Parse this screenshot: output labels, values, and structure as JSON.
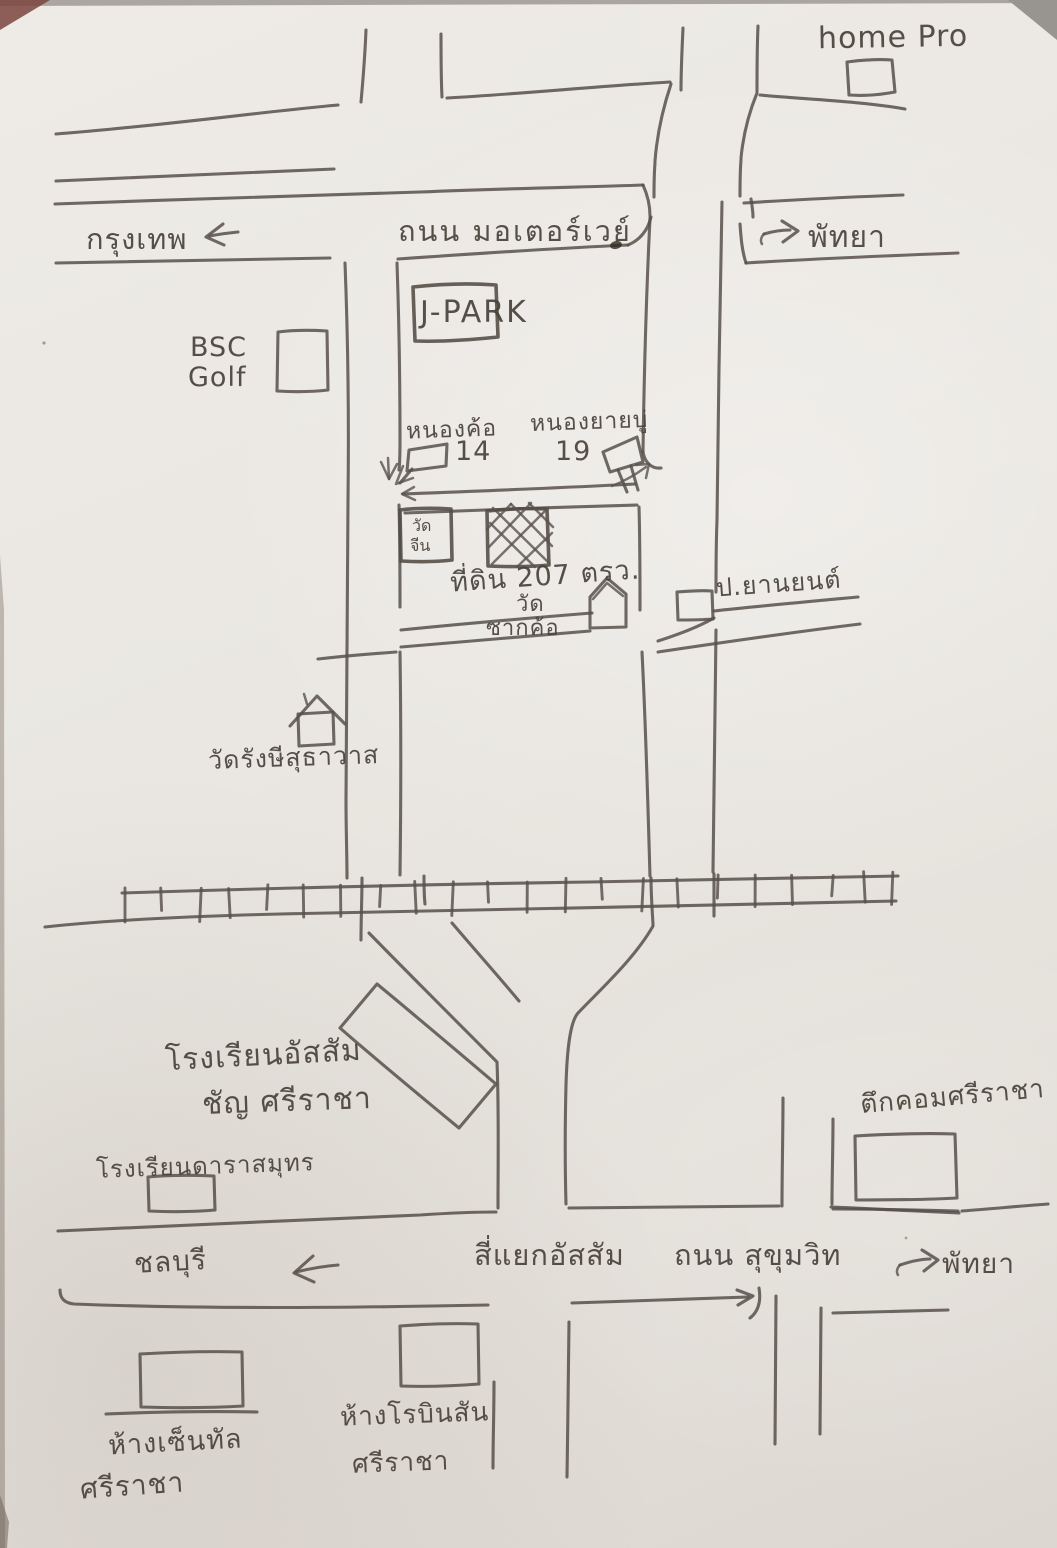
{
  "map": {
    "kind": "hand-drawn-sketch-map",
    "ink_color": "#57504a",
    "paper_color": "#eae7e2",
    "labels": {
      "home_pro": "home Pro",
      "bangkok": "กรุงเทพ",
      "motorway_road": "ถนน มอเตอร์เวย์",
      "pattaya_top": "พัทยา",
      "j_park": "J-PARK",
      "bsc_line1": "BSC",
      "bsc_line2": "Golf",
      "soi_left_name": "หนองค้อ",
      "soi_left_number": "14",
      "soi_right_name": "หนองยายบู่",
      "soi_right_number": "19",
      "wat_chin_line1": "วัด",
      "wat_chin_line2": "จีน",
      "land_plot": "ที่ดิน 207 ตรว.",
      "wat_sakkho_line1": "วัด",
      "wat_sakkho_line2": "ซากค้อ",
      "p_yanyon": "ป.ยานยนต์",
      "wat_rangsi": "วัดรังษีสุธาวาส",
      "assumption_line1": "โรงเรียนอัสสัม",
      "assumption_line2": "ชัญ ศรีราชา",
      "darasamut_school": "โรงเรียนดาราสมุทร",
      "tuk_com": "ตึกคอมศรีราชา",
      "chonburi": "ชลบุรี",
      "intersection": "สี่แยกอัสสัม",
      "sukhumvit_road": "ถนน สุขุมวิท",
      "pattaya_bottom": "พัทยา",
      "central_line1": "ห้างเซ็นทัล",
      "central_line2": "ศรีราชา",
      "robinson_line1": "ห้างโรบินสัน",
      "robinson_line2": "ศรีราชา"
    },
    "icons": {
      "bangkok_arrow": "left-arrow",
      "pattaya_top_arrow": "right-arrow",
      "chonburi_arrow": "left-arrow",
      "pattaya_bottom_arrow": "right-arrow",
      "soi_entry_arrow": "down-arrow",
      "wat_sakkho_icon": "house",
      "wat_rangsi_icon": "house",
      "soi_left_icon": "flag-sign",
      "soi_right_icon": "flag-sign",
      "railroad": "railway-track",
      "land_plot_icon": "cross-hatched-square"
    }
  }
}
